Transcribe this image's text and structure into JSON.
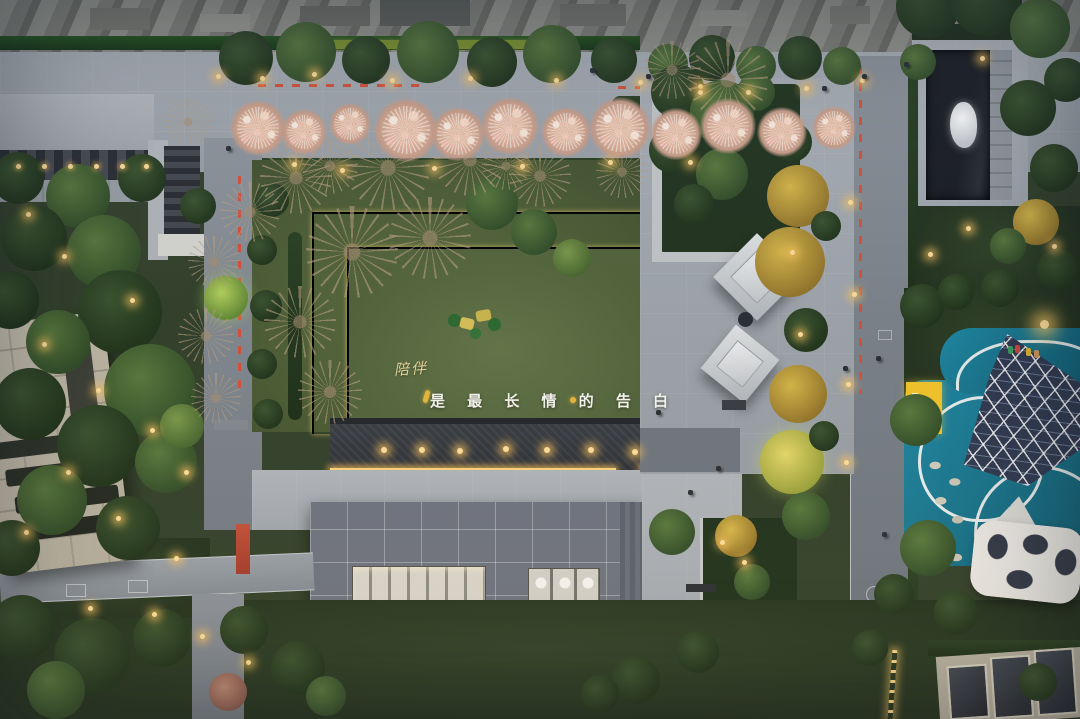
{
  "caption": {
    "line1": "陪伴",
    "line2": "是 最 长 情 的 告 白"
  },
  "palette": {
    "accent_gold": "#e3c269",
    "warm_light": "#ffd77c",
    "lawn_green": "#55673c",
    "dark_foliage": "#23361d",
    "playground_teal": "#1d7c94",
    "blossom_pink": "#e9bda6",
    "safety_red": "#d8523b",
    "roof_gray": "#6f7480",
    "paving_gray": "#a6abb1",
    "water_dark": "#33373d",
    "pool_dark": "#1d2025",
    "fence_green": "#234c22",
    "mat_yellow": "#f4c52b",
    "canopy_white": "#ebe9e4",
    "blue_marker_light": "#3e6bff",
    "building_beige": "#c6bfae"
  }
}
